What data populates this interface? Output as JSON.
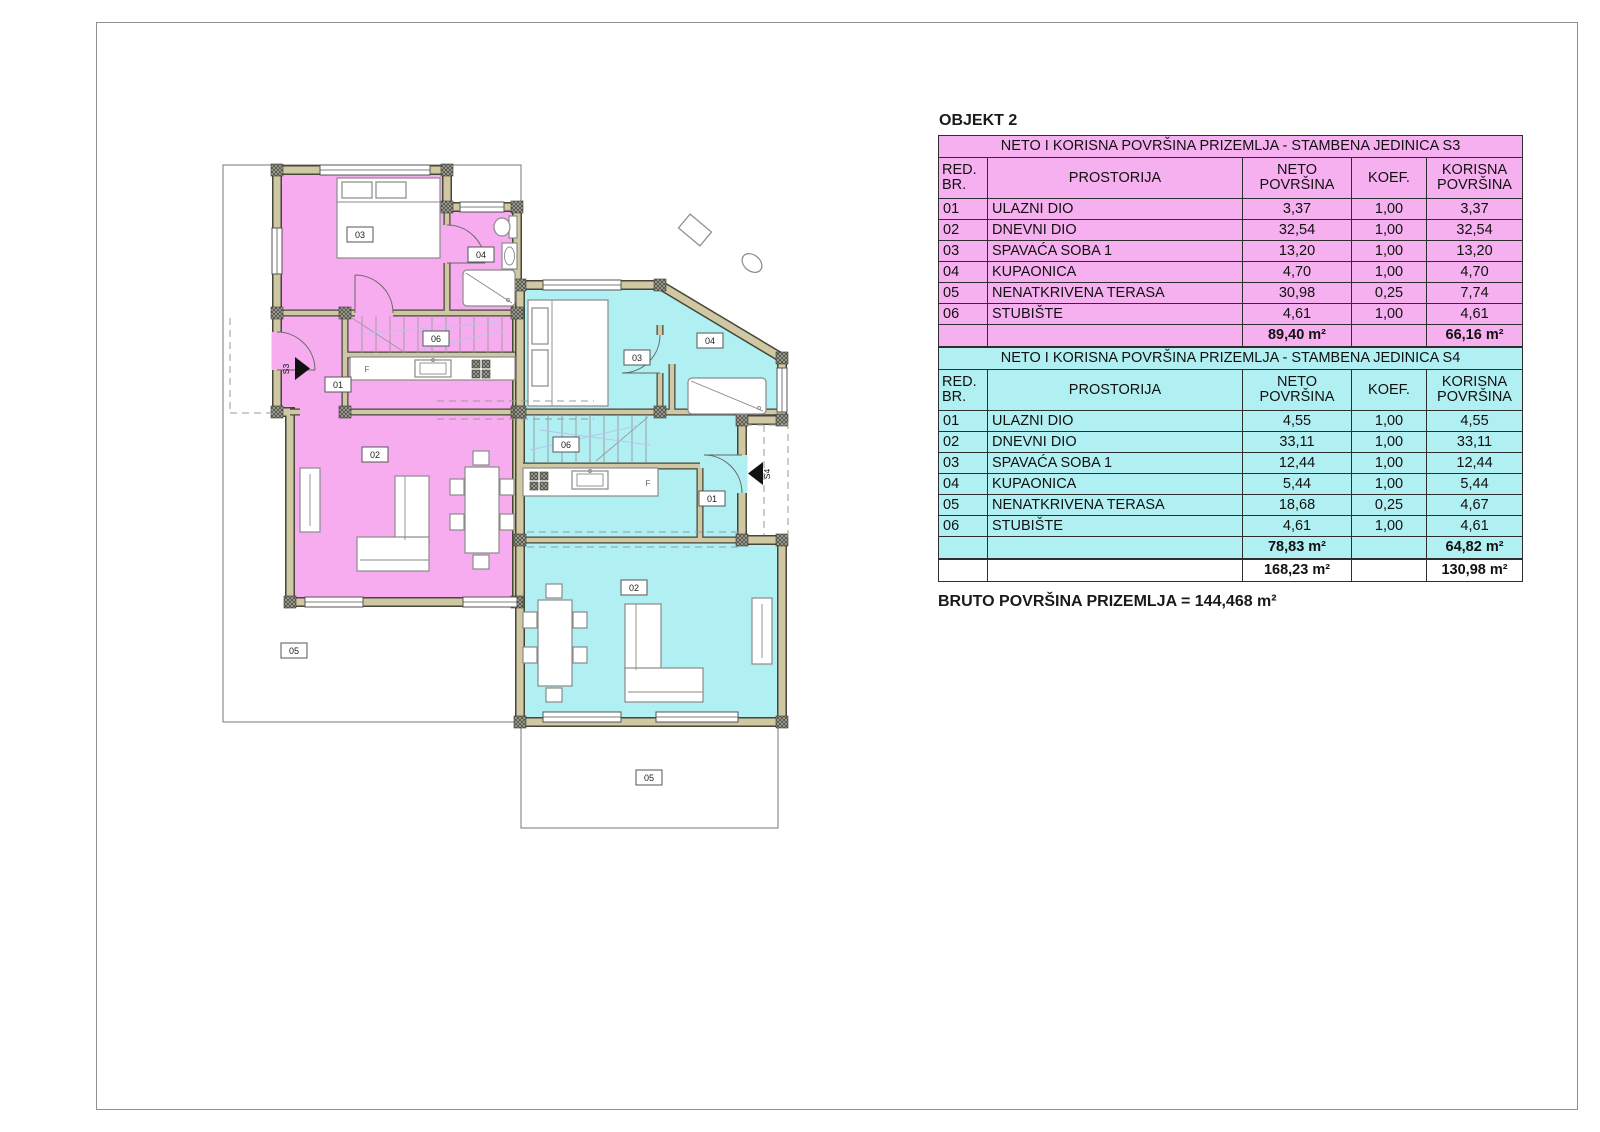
{
  "title": "OBJEKT 2",
  "bruto_label": "BRUTO POVRŠINA PRIZEMLJA = 144,468 m²",
  "tables": [
    {
      "title": "NETO I KORISNA POVRŠINA PRIZEMLJA - STAMBENA JEDINICA S3",
      "color": "#F6AFEF",
      "columns": {
        "red_br": "RED.\nBR.",
        "prostorija": "PROSTORIJA",
        "neto": "NETO\nPOVRŠINA",
        "koef": "KOEF.",
        "korisna": "KORISNA\nPOVRŠINA"
      },
      "rows": [
        {
          "br": "01",
          "name": "ULAZNI DIO",
          "neto": "3,37",
          "koef": "1,00",
          "korisna": "3,37"
        },
        {
          "br": "02",
          "name": "DNEVNI DIO",
          "neto": "32,54",
          "koef": "1,00",
          "korisna": "32,54"
        },
        {
          "br": "03",
          "name": "SPAVAĆA SOBA 1",
          "neto": "13,20",
          "koef": "1,00",
          "korisna": "13,20"
        },
        {
          "br": "04",
          "name": "KUPAONICA",
          "neto": "4,70",
          "koef": "1,00",
          "korisna": "4,70"
        },
        {
          "br": "05",
          "name": "NENATKRIVENA TERASA",
          "neto": "30,98",
          "koef": "0,25",
          "korisna": "7,74"
        },
        {
          "br": "06",
          "name": "STUBIŠTE",
          "neto": "4,61",
          "koef": "1,00",
          "korisna": "4,61"
        }
      ],
      "total_neto": "89,40 m²",
      "total_korisna": "66,16 m²"
    },
    {
      "title": "NETO I KORISNA POVRŠINA PRIZEMLJA - STAMBENA JEDINICA S4",
      "color": "#B0EFF2",
      "columns": {
        "red_br": "RED.\nBR.",
        "prostorija": "PROSTORIJA",
        "neto": "NETO\nPOVRŠINA",
        "koef": "KOEF.",
        "korisna": "KORISNA\nPOVRŠINA"
      },
      "rows": [
        {
          "br": "01",
          "name": "ULAZNI DIO",
          "neto": "4,55",
          "koef": "1,00",
          "korisna": "4,55"
        },
        {
          "br": "02",
          "name": "DNEVNI DIO",
          "neto": "33,11",
          "koef": "1,00",
          "korisna": "33,11"
        },
        {
          "br": "03",
          "name": "SPAVAĆA SOBA 1",
          "neto": "12,44",
          "koef": "1,00",
          "korisna": "12,44"
        },
        {
          "br": "04",
          "name": "KUPAONICA",
          "neto": "5,44",
          "koef": "1,00",
          "korisna": "5,44"
        },
        {
          "br": "05",
          "name": "NENATKRIVENA TERASA",
          "neto": "18,68",
          "koef": "0,25",
          "korisna": "4,67"
        },
        {
          "br": "06",
          "name": "STUBIŠTE",
          "neto": "4,61",
          "koef": "1,00",
          "korisna": "4,61"
        }
      ],
      "total_neto": "78,83 m²",
      "total_korisna": "64,82 m²"
    }
  ],
  "grand_total": {
    "neto": "168,23 m²",
    "korisna": "130,98 m²"
  },
  "plan": {
    "s3": {
      "unit": "S3",
      "bedroom": "03",
      "bath": "04",
      "stairs": "06",
      "entry": "01",
      "living": "02",
      "terrace": "05",
      "fridge": "F"
    },
    "s4": {
      "unit": "S4",
      "bedroom": "03",
      "bath": "04",
      "stairs": "06",
      "entry": "01",
      "living": "02",
      "terrace": "05",
      "fridge": "F"
    }
  }
}
